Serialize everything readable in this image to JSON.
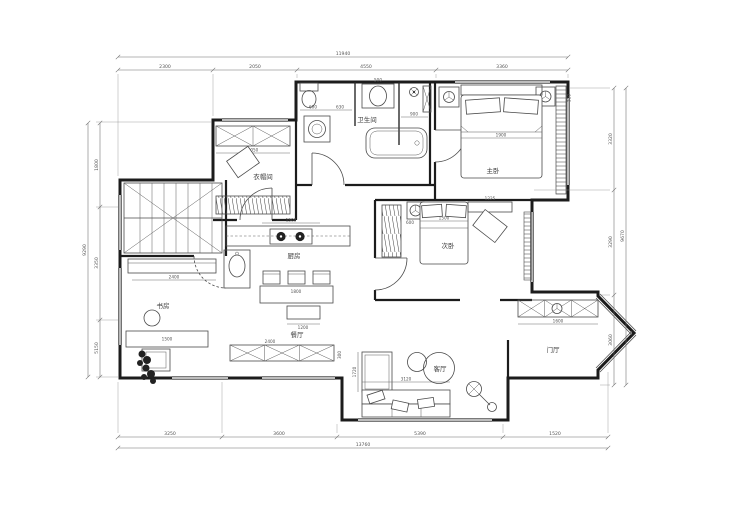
{
  "rooms": {
    "bathroom": "卫生间",
    "master": "主卧",
    "second": "次卧",
    "cloakroom": "衣帽间",
    "kitchen": "厨房",
    "dining": "餐厅",
    "study": "书房",
    "living": "客厅",
    "hall": "门厅"
  },
  "dims": {
    "top": {
      "total": "11940",
      "segs": [
        "2300",
        "2050",
        "4550",
        "3360"
      ]
    },
    "bottom": {
      "total": "13760",
      "segs": [
        "3250",
        "3600",
        "5390",
        "1520"
      ]
    },
    "left": {
      "total": "9290",
      "segs": [
        "1800",
        "3350",
        "5150"
      ]
    },
    "right": {
      "total": "9670",
      "segs": [
        "3320",
        "3290",
        "3060"
      ]
    }
  },
  "inner": {
    "master_bed": "1900",
    "lamp": "510",
    "bath_w": "900",
    "basin": "500",
    "b600": "600",
    "b630": "630",
    "bed2": "1500",
    "bed2_gap": "600",
    "shelf": "1225",
    "cloak_cab": "2050",
    "kitchen": "1500",
    "table": "1800",
    "bench": "1200",
    "din_cab": "2400",
    "din_cab_d": "300",
    "study_cab": "2400",
    "desk": "1500",
    "shoe_cab": "1600",
    "sofa": "3120",
    "chaise": "1720"
  },
  "colors": {
    "wall": "#1c1c1c",
    "line": "#4a4a4a",
    "dim": "#6a6a6a",
    "bg": "#ffffff"
  }
}
